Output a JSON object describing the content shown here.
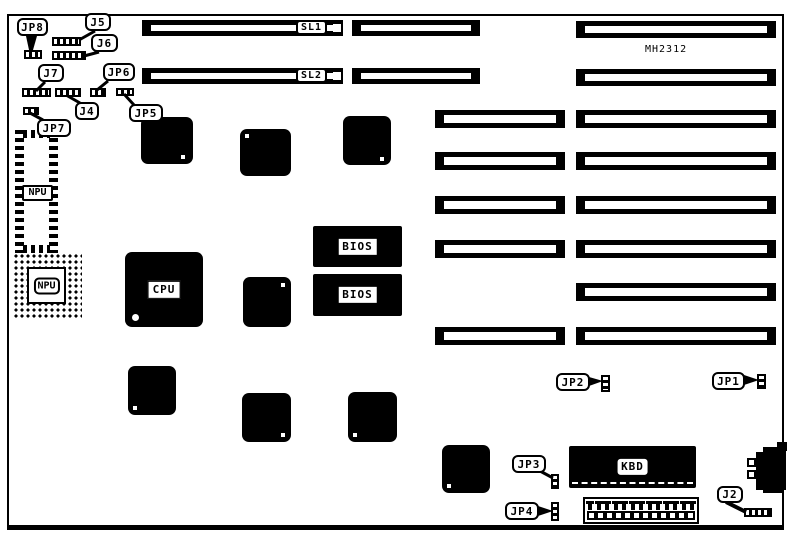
{
  "board": {
    "model_number": "MH2312"
  },
  "slot_labels": {
    "sl1": "SL1",
    "sl2": "SL2"
  },
  "jumper_labels": {
    "jp1": "JP1",
    "jp2": "JP2",
    "jp3": "JP3",
    "jp4": "JP4",
    "jp5": "JP5",
    "jp6": "JP6",
    "jp7": "JP7",
    "jp8": "JP8",
    "j2": "J2",
    "j4": "J4",
    "j5": "J5",
    "j6": "J6",
    "j7": "J7"
  },
  "chip_labels": {
    "cpu": "CPU",
    "npu_socket": "NPU",
    "npu_pga": "NPU",
    "bios_top": "BIOS",
    "bios_bottom": "BIOS",
    "kbd": "KBD"
  },
  "colors": {
    "ink": "#000000",
    "background": "#ffffff"
  }
}
